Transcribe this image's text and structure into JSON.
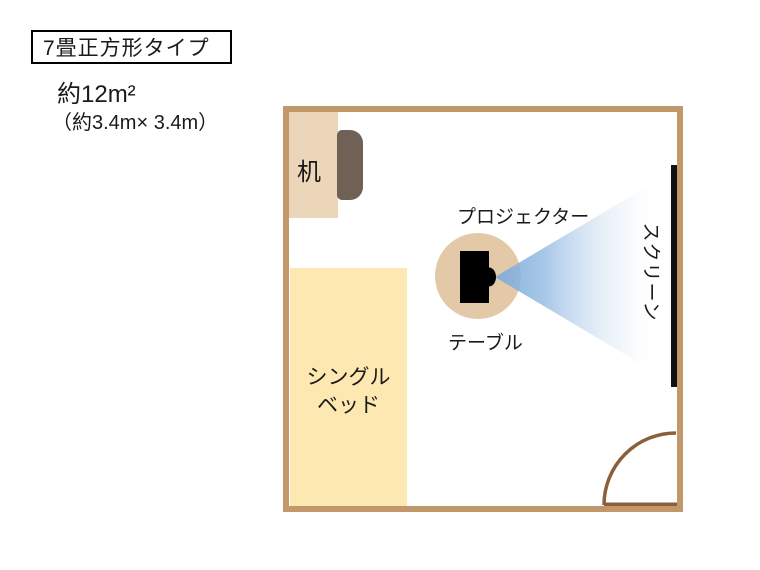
{
  "title": "7畳正方形タイプ",
  "area": {
    "size": "約12m²",
    "dimensions": "（約3.4m× 3.4m）"
  },
  "room": {
    "desk": {
      "label": "机"
    },
    "bed": {
      "label_lines": [
        "シングル",
        "ベッド"
      ]
    },
    "table": {
      "label": "テーブル"
    },
    "projector": {
      "label": "プロジェクター"
    },
    "screen": {
      "label": "スクリーン"
    }
  },
  "colors": {
    "wall": "#c2986a",
    "door": "#8a5f3a",
    "desk": "#ecd6ba",
    "chair": "#6f6155",
    "bed": "#fce8b0",
    "table": "#e3c9a7",
    "cone-start": "#7dabda",
    "screen": "#111111",
    "text": "#1a1a1a"
  }
}
